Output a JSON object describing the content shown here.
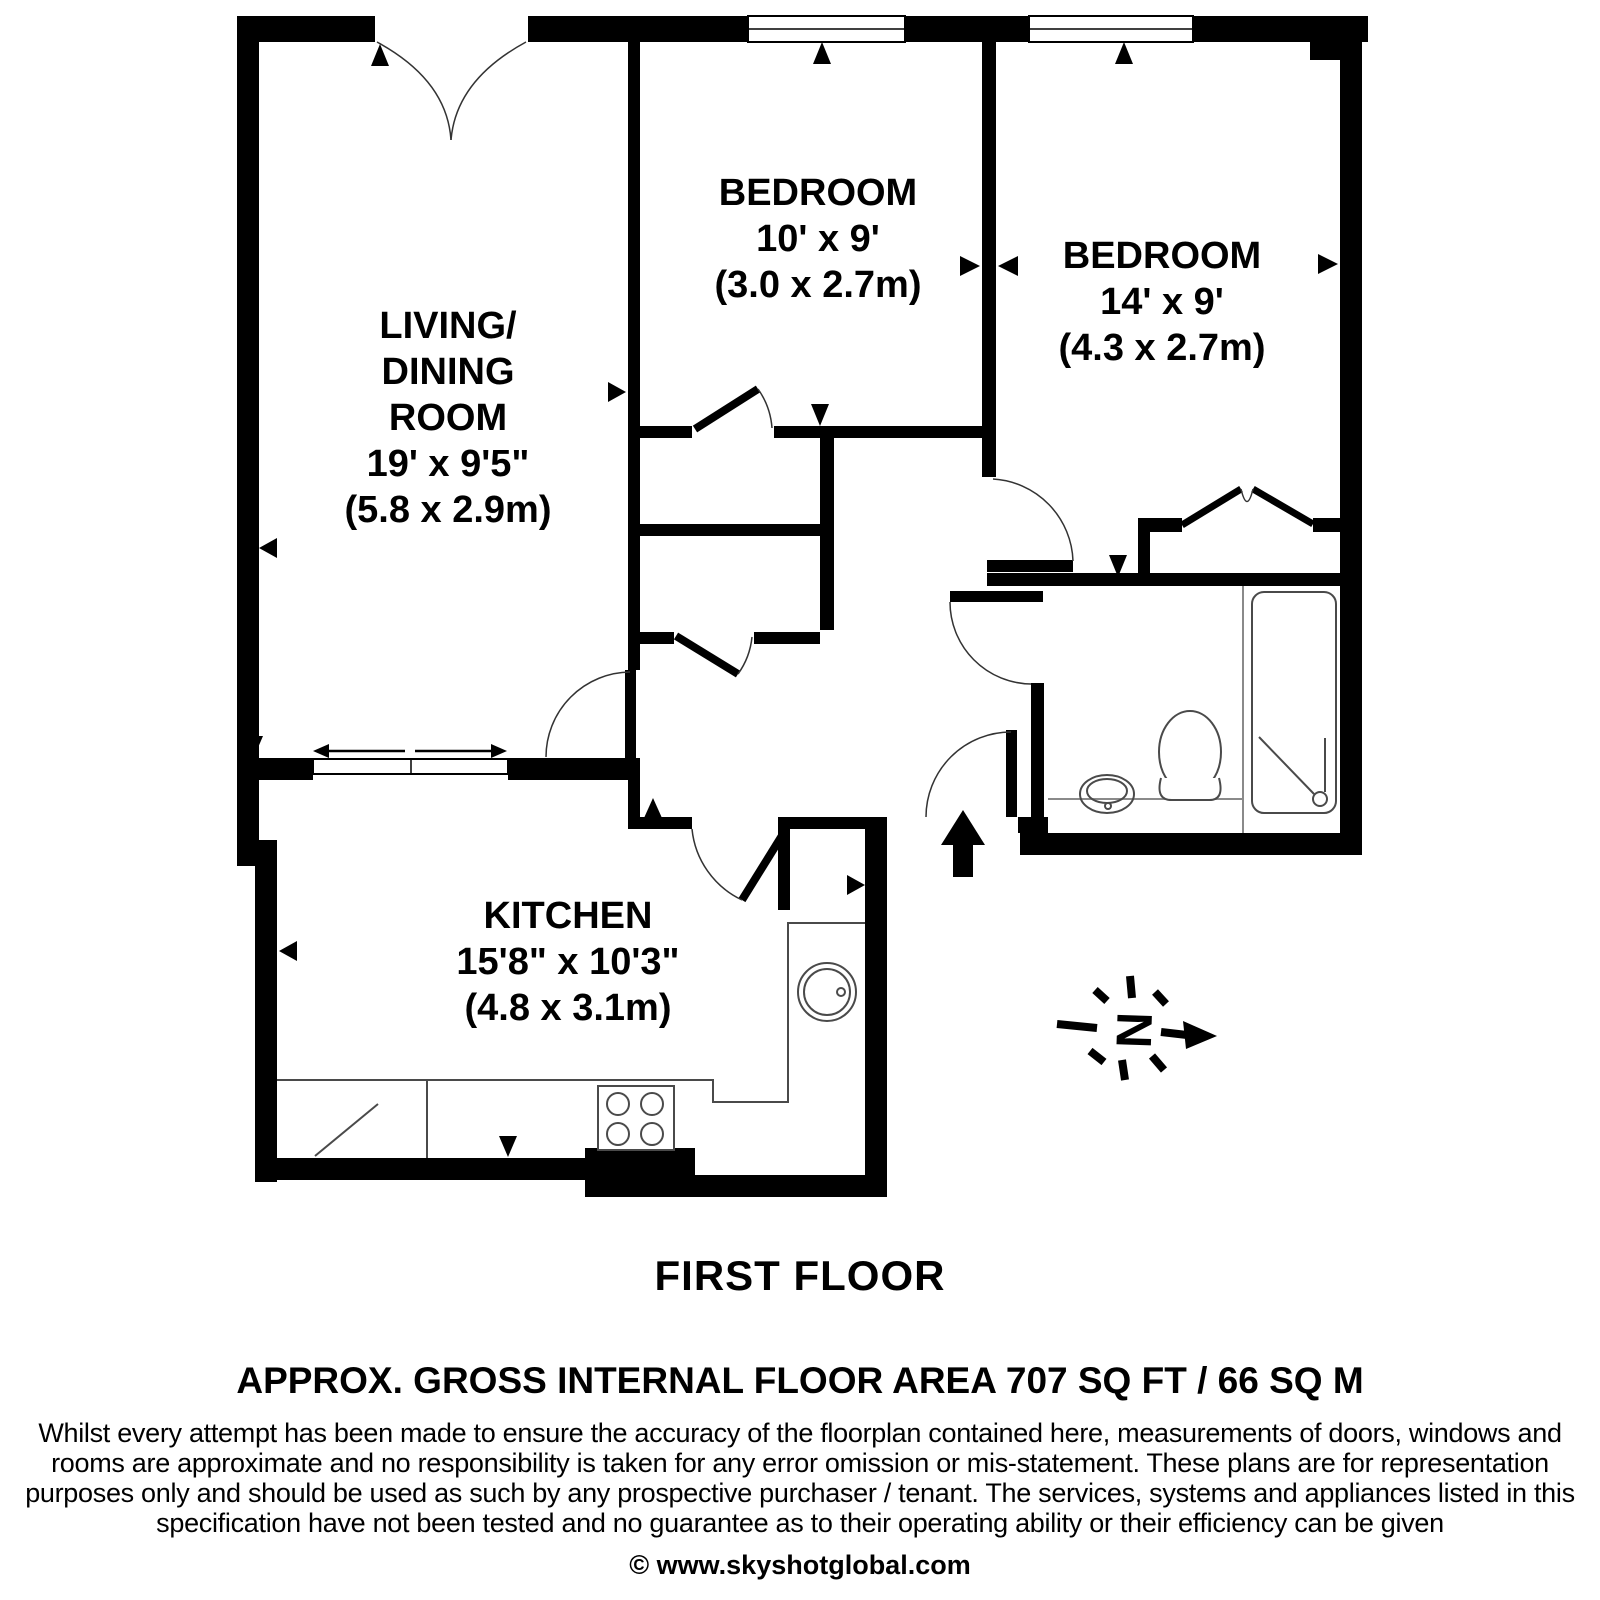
{
  "plan": {
    "living_dining": {
      "line1": "LIVING/",
      "line2": "DINING",
      "line3": "ROOM",
      "dim_ft": "19' x 9'5\"",
      "dim_m": "(5.8 x 2.9m)"
    },
    "bedroom_small": {
      "name": "BEDROOM",
      "dim_ft": "10' x 9'",
      "dim_m": "(3.0 x 2.7m)"
    },
    "bedroom_large": {
      "name": "BEDROOM",
      "dim_ft": "14' x 9'",
      "dim_m": "(4.3 x 2.7m)"
    },
    "kitchen": {
      "name": "KITCHEN",
      "dim_ft": "15'8\" x 10'3\"",
      "dim_m": "(4.8 x 3.1m)"
    },
    "compass_letter": "N"
  },
  "footer": {
    "floor_label": "FIRST FLOOR",
    "area_label": "APPROX. GROSS INTERNAL FLOOR AREA 707 SQ FT / 66 SQ M",
    "disclaimer_line1": "Whilst every attempt has been made to ensure the accuracy of the floorplan contained here, measurements of doors, windows and",
    "disclaimer_line2": "rooms are approximate and no responsibility is taken for any error omission or mis-statement. These plans are for representation",
    "disclaimer_line3": "purposes only and should  be used as such by any prospective purchaser / tenant. The services, systems and appliances listed in this",
    "disclaimer_line4": "specification have not been tested and no guarantee as to their operating ability or their efficiency can be given",
    "copyright": "© www.skyshotglobal.com"
  },
  "colors": {
    "wall": "#000000",
    "background": "#ffffff",
    "fixture_line": "#4a4a4a",
    "thin_line": "#8a8a8a"
  }
}
